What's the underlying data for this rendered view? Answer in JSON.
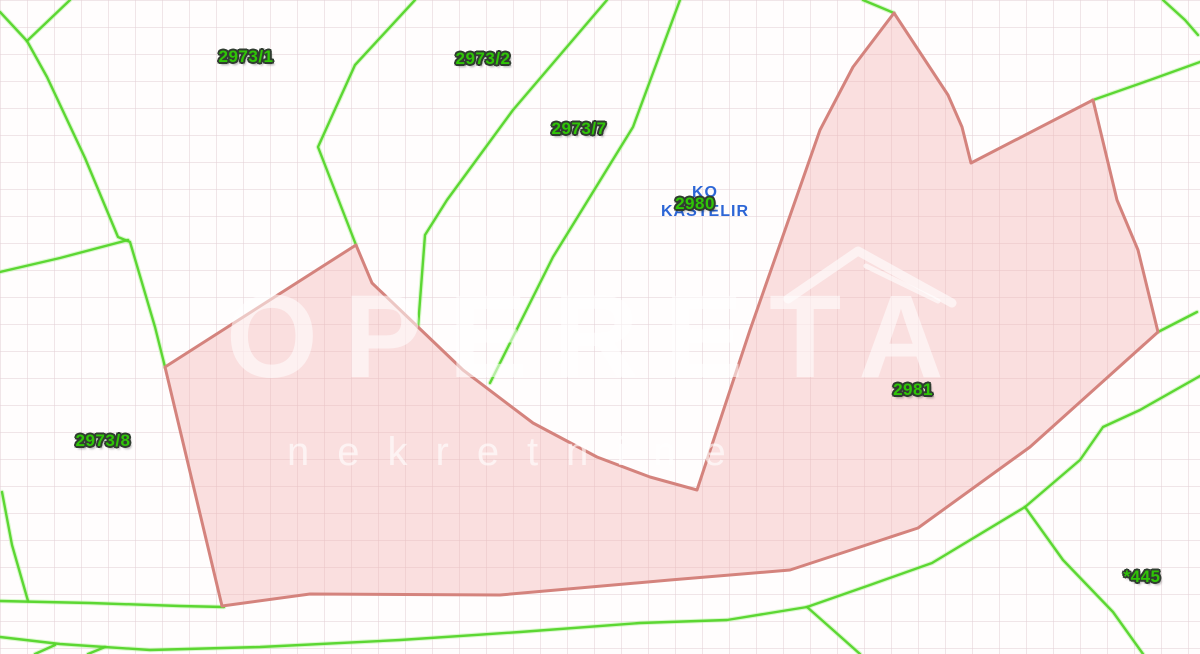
{
  "map": {
    "ko_label": {
      "line1": "KO",
      "line2": "KAŠTELIR",
      "x": 705,
      "y": 202,
      "color": "#2d66d6"
    },
    "parcel_labels": [
      {
        "id": "2973-1",
        "text": "2973/1",
        "x": 246,
        "y": 57
      },
      {
        "id": "2973-2",
        "text": "2973/2",
        "x": 483,
        "y": 59
      },
      {
        "id": "2973-7",
        "text": "2973/7",
        "x": 579,
        "y": 129
      },
      {
        "id": "2980",
        "text": "2980",
        "x": 695,
        "y": 204
      },
      {
        "id": "2973-8",
        "text": "2973/8",
        "x": 103,
        "y": 441
      },
      {
        "id": "2981",
        "text": "2981",
        "x": 913,
        "y": 390
      },
      {
        "id": "445",
        "text": "*445",
        "x": 1142,
        "y": 577
      }
    ],
    "highlight_parcel": {
      "fill": "#f2b4b4",
      "fill_opacity": 0.42,
      "stroke": "#d4837d",
      "stroke_width": 3,
      "points": [
        [
          165,
          367
        ],
        [
          356,
          245
        ],
        [
          372,
          283
        ],
        [
          418,
          327
        ],
        [
          463,
          370
        ],
        [
          533,
          423
        ],
        [
          597,
          457
        ],
        [
          650,
          477
        ],
        [
          697,
          490
        ],
        [
          750,
          330
        ],
        [
          820,
          130
        ],
        [
          853,
          67
        ],
        [
          894,
          13
        ],
        [
          948,
          95
        ],
        [
          962,
          127
        ],
        [
          971,
          163
        ],
        [
          1093,
          100
        ],
        [
          1117,
          200
        ],
        [
          1138,
          250
        ],
        [
          1158,
          332
        ],
        [
          1030,
          447
        ],
        [
          918,
          528
        ],
        [
          790,
          570
        ],
        [
          670,
          580
        ],
        [
          500,
          595
        ],
        [
          310,
          594
        ],
        [
          222,
          606
        ]
      ]
    },
    "boundary_lines": {
      "color": "#55d52a",
      "width": 2.4,
      "polylines": [
        [
          [
            70,
            0
          ],
          [
            27,
            41
          ],
          [
            0,
            12
          ]
        ],
        [
          [
            27,
            41
          ],
          [
            47,
            77
          ],
          [
            85,
            158
          ],
          [
            118,
            237
          ],
          [
            130,
            242
          ],
          [
            155,
            327
          ],
          [
            165,
            367
          ]
        ],
        [
          [
            128,
            240
          ],
          [
            60,
            258
          ],
          [
            0,
            272
          ]
        ],
        [
          [
            2,
            492
          ],
          [
            12,
            545
          ],
          [
            28,
            601
          ]
        ],
        [
          [
            0,
            601
          ],
          [
            90,
            603
          ],
          [
            180,
            606
          ],
          [
            224,
            607
          ]
        ],
        [
          [
            0,
            637
          ],
          [
            60,
            644
          ],
          [
            150,
            650
          ],
          [
            260,
            647
          ],
          [
            400,
            640
          ],
          [
            520,
            632
          ],
          [
            640,
            623
          ],
          [
            727,
            620
          ],
          [
            807,
            607
          ],
          [
            870,
            585
          ],
          [
            932,
            563
          ],
          [
            1025,
            507
          ],
          [
            1080,
            460
          ],
          [
            1103,
            427
          ],
          [
            1140,
            410
          ],
          [
            1200,
            376
          ]
        ],
        [
          [
            807,
            607
          ],
          [
            833,
            630
          ],
          [
            860,
            654
          ]
        ],
        [
          [
            1025,
            507
          ],
          [
            1063,
            560
          ],
          [
            1113,
            612
          ],
          [
            1143,
            654
          ]
        ],
        [
          [
            55,
            645
          ],
          [
            35,
            654
          ]
        ],
        [
          [
            105,
            647
          ],
          [
            88,
            654
          ]
        ],
        [
          [
            415,
            0
          ],
          [
            355,
            65
          ],
          [
            318,
            147
          ],
          [
            356,
            245
          ]
        ],
        [
          [
            607,
            0
          ],
          [
            513,
            110
          ],
          [
            447,
            200
          ],
          [
            425,
            235
          ],
          [
            418,
            327
          ]
        ],
        [
          [
            680,
            0
          ],
          [
            633,
            127
          ],
          [
            553,
            257
          ],
          [
            490,
            383
          ]
        ],
        [
          [
            863,
            0
          ],
          [
            894,
            13
          ]
        ],
        [
          [
            1163,
            0
          ],
          [
            1185,
            20
          ],
          [
            1198,
            35
          ]
        ],
        [
          [
            1200,
            62
          ],
          [
            1150,
            80
          ],
          [
            1093,
            100
          ]
        ],
        [
          [
            1197,
            312
          ],
          [
            1158,
            332
          ]
        ]
      ]
    },
    "watermark": {
      "brand": "OPERETA",
      "subtitle": "nekretnine",
      "brand_color": "rgba(255,255,255,0.55)",
      "subtitle_color": "rgba(255,255,255,0.62)",
      "roof_color": "rgba(255,255,255,0.6)",
      "roof_lines": [
        {
          "points": [
            [
              788,
              299
            ],
            [
              858,
              251
            ],
            [
              952,
              303
            ]
          ],
          "width": 9
        },
        {
          "points": [
            [
              866,
              266
            ],
            [
              938,
              301
            ]
          ],
          "width": 5
        }
      ]
    },
    "grid": {
      "size": 27,
      "color": "#e4d1d6"
    }
  }
}
